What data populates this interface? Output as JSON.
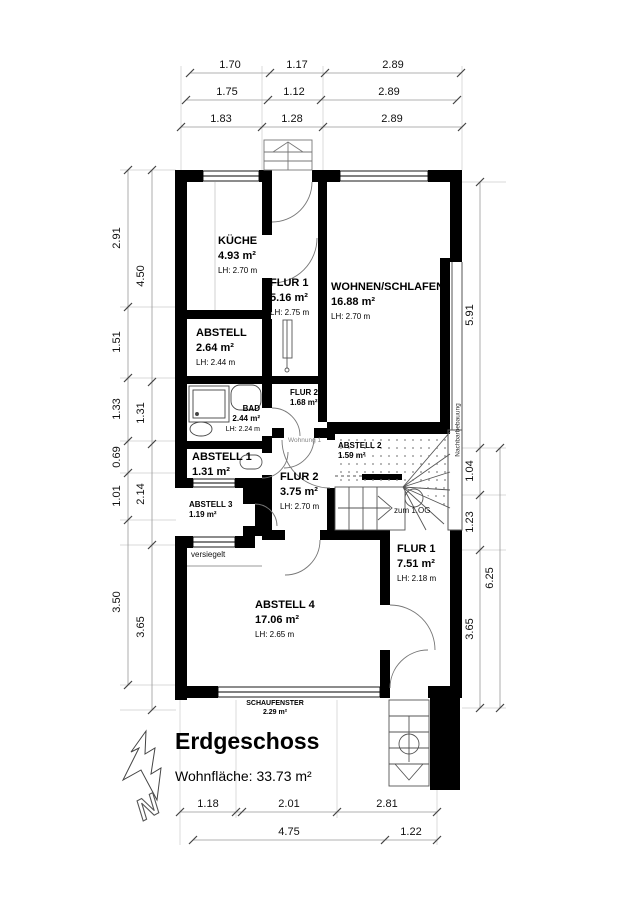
{
  "plan": {
    "title": "Erdgeschoss",
    "area_total": "Wohnfläche: 33.73 m²",
    "north_letter": "N"
  },
  "rooms": {
    "kueche": {
      "name": "KÜCHE",
      "area": "4.93 m²",
      "lh": "LH: 2.70 m"
    },
    "flur1_oben": {
      "name": "FLUR 1",
      "area": "5.16 m²",
      "lh": "LH: 2.75 m"
    },
    "wohnen": {
      "name": "WOHNEN/SCHLAFEN",
      "area": "16.88 m²",
      "lh": "LH: 2.70 m"
    },
    "abstell": {
      "name": "ABSTELL",
      "area": "2.64 m²",
      "lh": "LH: 2.44 m"
    },
    "bad": {
      "name": "BAD",
      "area": "2.44 m²",
      "lh": "LH: 2.24 m"
    },
    "flur2_klein": {
      "name": "FLUR 2",
      "area": "1.68 m²"
    },
    "abstell1": {
      "name": "ABSTELL 1",
      "area": "1.31 m²"
    },
    "abstell2": {
      "name": "ABSTELL 2",
      "area": "1.59 m²"
    },
    "abstell3": {
      "name": "ABSTELL 3",
      "area": "1.19 m²"
    },
    "flur2_gross": {
      "name": "FLUR 2",
      "area": "3.75 m²",
      "lh": "LH: 2.70 m"
    },
    "flur1_unten": {
      "name": "FLUR 1",
      "area": "7.51 m²",
      "lh": "LH: 2.18 m"
    },
    "abstell4": {
      "name": "ABSTELL 4",
      "area": "17.06 m²",
      "lh": "LH: 2.65 m"
    },
    "schaufenster": {
      "name": "SCHAUFENSTER",
      "area": "2.29 m²"
    }
  },
  "annotations": {
    "zum_og": "zum 1.OG",
    "wohnung": "Wohnung 1",
    "versiegelt": "versiegelt",
    "nachbar": "Nachbarbebauung"
  },
  "dims": {
    "top": [
      [
        "1.70",
        "1.17",
        "2.89"
      ],
      [
        "1.75",
        "1.12",
        "2.89"
      ],
      [
        "1.83",
        "1.28",
        "2.89"
      ]
    ],
    "bottom_upper": [
      "1.18",
      "2.01",
      "2.81"
    ],
    "bottom_lower": [
      "4.75",
      "1.22"
    ],
    "left_outer": [
      "2.91",
      "1.51",
      "1.33",
      "0.69",
      "1.01",
      "3.50"
    ],
    "left_inner": [
      "4.50",
      "1.31",
      "2.14",
      "3.65"
    ],
    "right_inner": [
      "5.91",
      "1.04",
      "1.23",
      "3.65"
    ],
    "right_outer": [
      "6.25"
    ]
  }
}
